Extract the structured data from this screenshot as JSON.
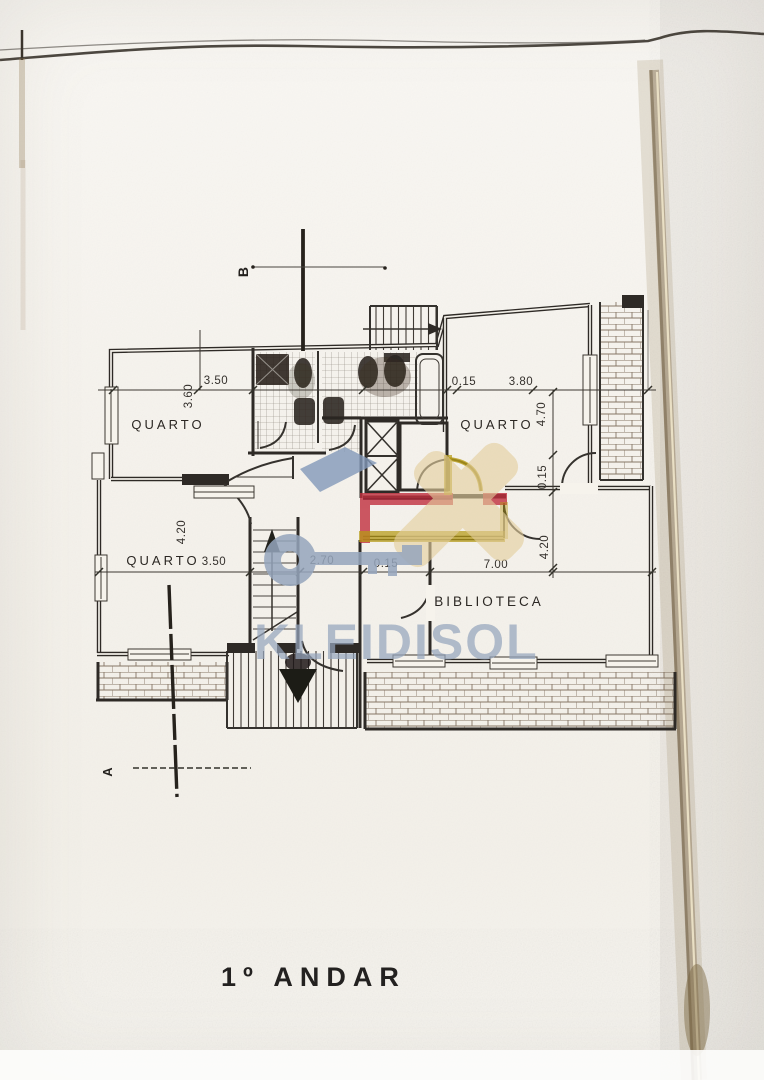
{
  "floor_plan": {
    "caption": "1º ANDAR",
    "watermark": {
      "text": "KLEIDISOL"
    },
    "section_markers": {
      "top": "B",
      "bottom": "A"
    },
    "rooms": {
      "quarto_top_left": "QUARTO",
      "quarto_top_right": "QUARTO",
      "quarto_middle_left": "QUARTO",
      "biblioteca": "BIBLIOTECA"
    },
    "dimensions": {
      "top_width_left": "3.50",
      "top_depth_left": "3.60",
      "top_wall": "0.15",
      "top_width_right": "3.80",
      "right_depth_top": "4.70",
      "right_wall": "0.15",
      "right_depth_bottom": "4.20",
      "left_depth": "4.20",
      "mid_width_left": "3.50",
      "mid_width_stairs": "2.70",
      "mid_wall": "0.15",
      "mid_width_biblioteca": "7.00"
    },
    "colors": {
      "wall_highlight_red": "#c12f3e",
      "wall_highlight_yellow": "#b59a15",
      "watermark_blue": "#96a6bd",
      "watermark_slate": "#8299b9",
      "watermark_tan": "#e4cf9e"
    }
  }
}
